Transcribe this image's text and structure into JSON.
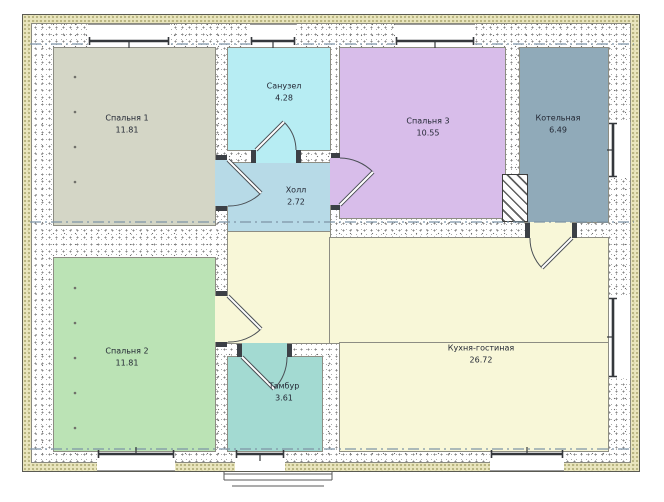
{
  "rooms": [
    {
      "id": "bedroom-1",
      "name": "Спальня 1",
      "area": "11.81",
      "color": "#d4d6c6"
    },
    {
      "id": "bathroom",
      "name": "Санузел",
      "area": "4.28",
      "color": "#b7edf3"
    },
    {
      "id": "hall",
      "name": "Холл",
      "area": "2.72",
      "color": "#b7dae7"
    },
    {
      "id": "bedroom-3",
      "name": "Спальня 3",
      "area": "10.55",
      "color": "#d8bdea"
    },
    {
      "id": "boiler-room",
      "name": "Котельная",
      "area": "6.49",
      "color": "#90aab9"
    },
    {
      "id": "bedroom-2",
      "name": "Спальня 2",
      "area": "11.81",
      "color": "#bbe3b5"
    },
    {
      "id": "vestibule",
      "name": "Тамбур",
      "area": "3.61",
      "color": "#a3dad2"
    },
    {
      "id": "kitchen-living-room",
      "name": "Кухня-гостиная",
      "area": "26.72",
      "color": "#f8f7d8"
    }
  ],
  "palette": {
    "wall_fill": "#ffffff",
    "insulation": "#e9e5bd",
    "window_frame": "#35383c",
    "door_line": "#4a4f55",
    "axis_line": "#7e95a6"
  }
}
